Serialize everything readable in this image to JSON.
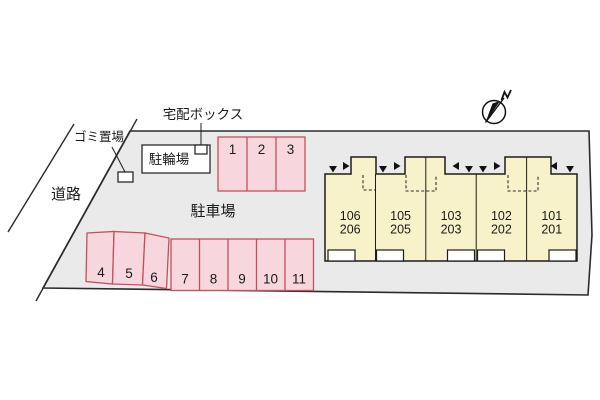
{
  "site": {
    "road_label": "道路",
    "garbage_label": "ゴミ置場",
    "delivery_box_label": "宅配ボックス",
    "bicycle_parking_label": "駐輪場",
    "parking_lot_label": "駐車場"
  },
  "parking": {
    "top_row": [
      "1",
      "2",
      "3"
    ],
    "angled_row": [
      "4",
      "5",
      "6"
    ],
    "bottom_row": [
      "7",
      "8",
      "9",
      "10",
      "11"
    ]
  },
  "building": {
    "units": [
      {
        "line1": "106",
        "line2": "206"
      },
      {
        "line1": "105",
        "line2": "205"
      },
      {
        "line1": "103",
        "line2": "203"
      },
      {
        "line1": "102",
        "line2": "202"
      },
      {
        "line1": "101",
        "line2": "201"
      }
    ]
  },
  "colors": {
    "site_fill": "#eaeaea",
    "site_border": "#2b2b2b",
    "building_fill": "#f8f2cb",
    "building_border": "#1c1c1c",
    "parking_fill": "#f7d6de",
    "parking_border": "#c4505e",
    "text": "#1a1a1a",
    "background": "#ffffff"
  }
}
